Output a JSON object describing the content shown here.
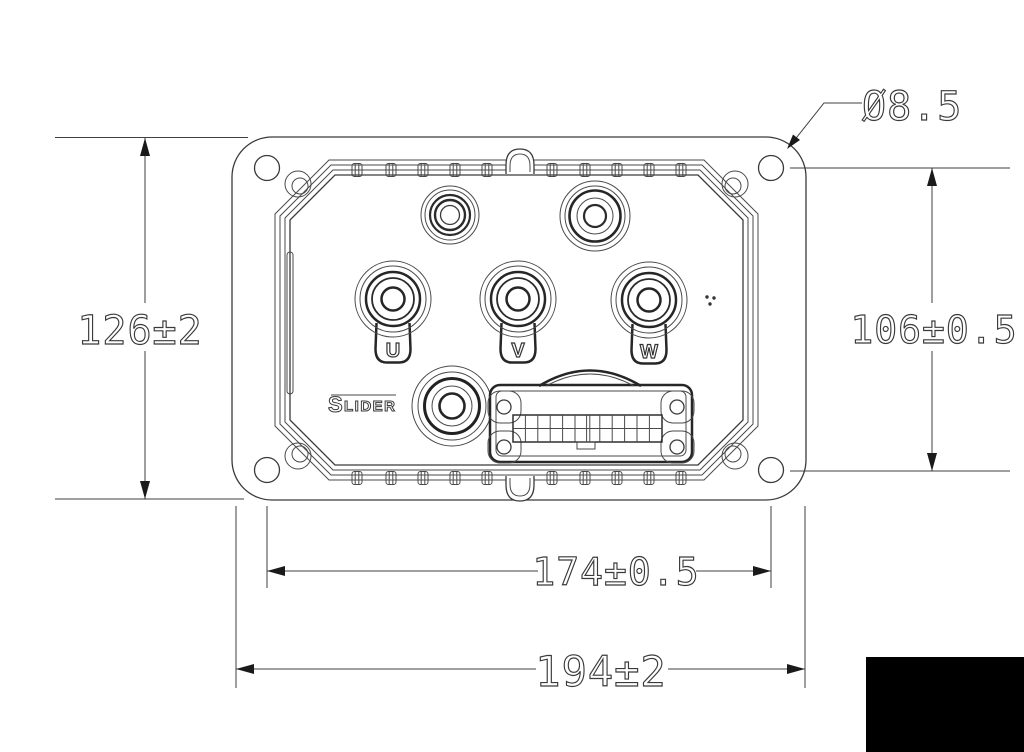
{
  "dimensions": {
    "hole_diameter": "Ø8.5",
    "overall_height": "126±2",
    "mount_hole_height": "106±0.5",
    "mount_hole_width": "174±0.5",
    "overall_width": "194±2"
  },
  "terminals": {
    "u": "U",
    "v": "V",
    "w": "W"
  },
  "logo": {
    "first_letter": "S",
    "rest": "LIDER"
  },
  "colors": {
    "line": "#3a3a3a",
    "dim_text": "#3a3a3a",
    "redaction": "#000000"
  }
}
